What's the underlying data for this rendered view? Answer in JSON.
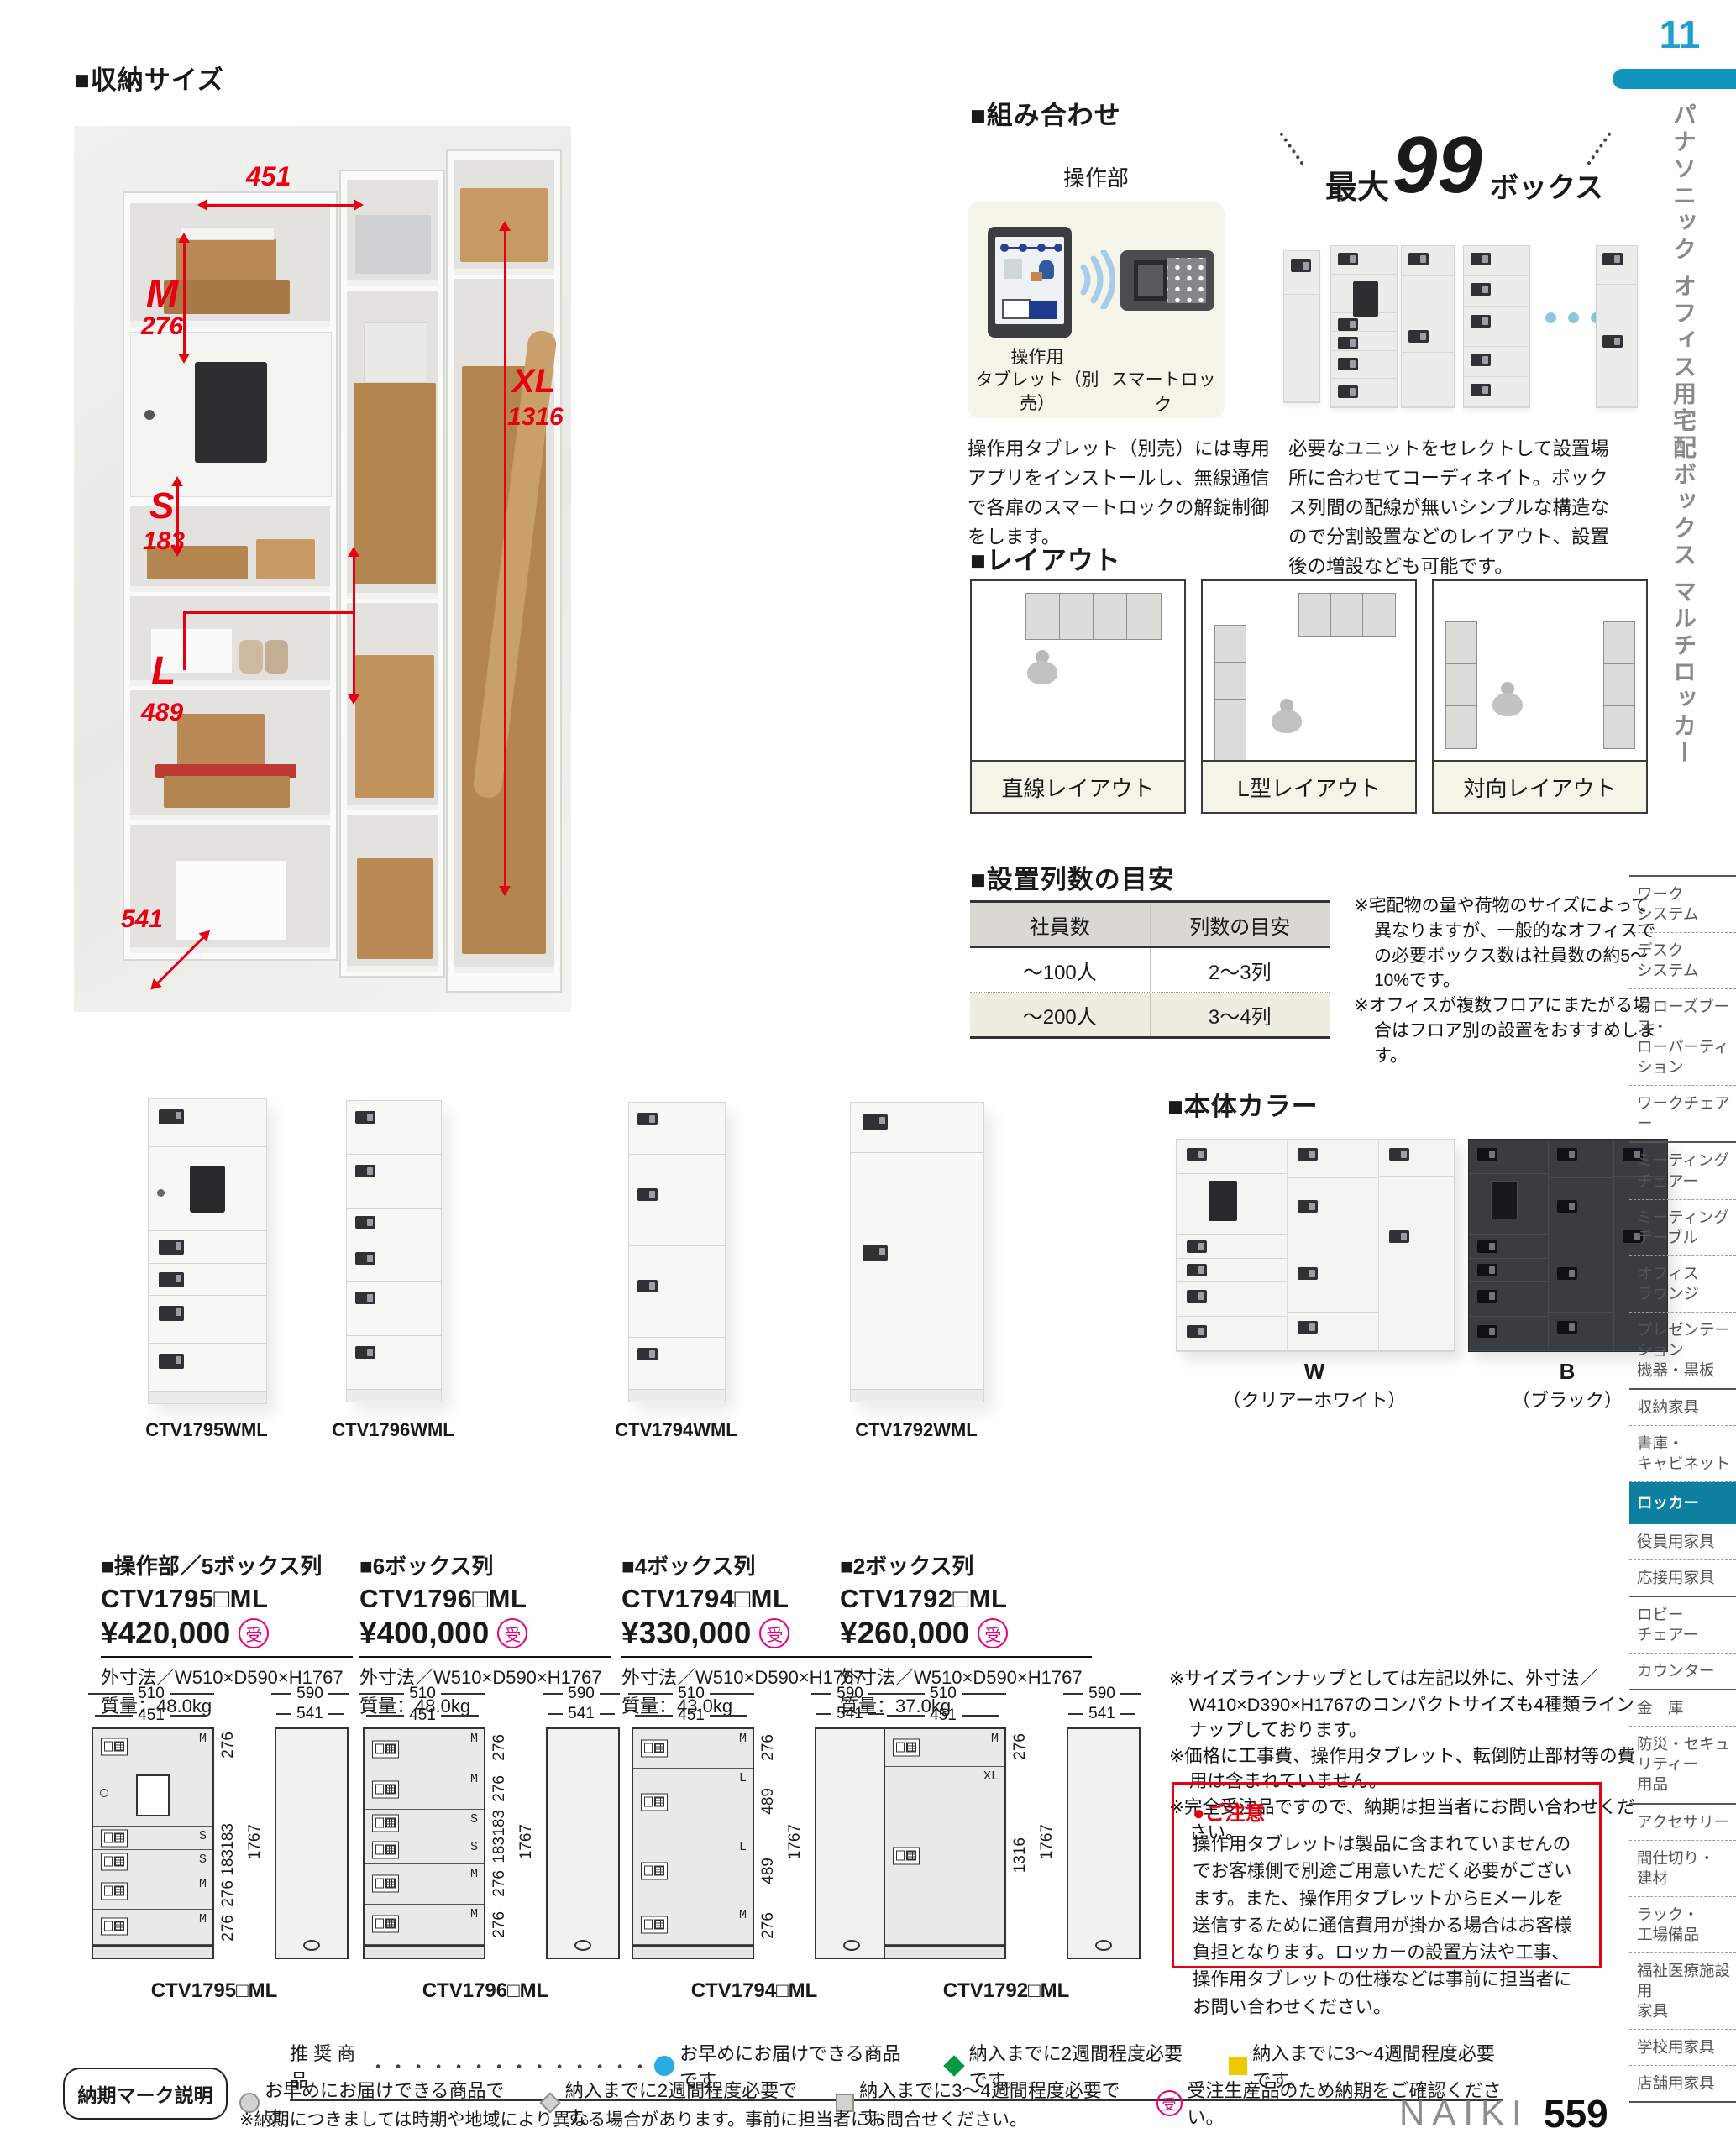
{
  "page": {
    "number": "11",
    "catalog_code": "559",
    "brand": "NAIKI",
    "side_title": "パナソニック オフィス用宅配ボックス マルチロッカー"
  },
  "colors": {
    "accent_red": "#e60012",
    "brand_blue": "#1f9fd0",
    "bar_blue": "#1095c1",
    "sidebar_highlight": "#0e7f9e",
    "order_pink": "#e4007f",
    "beige": "#f5f4e8",
    "mark_blue": "#29abe2",
    "mark_green": "#009944",
    "mark_yellow": "#efc800"
  },
  "storage_size": {
    "heading": "■収納サイズ",
    "dims": {
      "width": "451",
      "m_label": "M",
      "m": "276",
      "s_label": "S",
      "s": "183",
      "l_label": "L",
      "l": "489",
      "xl_label": "XL",
      "xl": "1316",
      "depth": "541"
    }
  },
  "combination": {
    "heading": "■組み合わせ",
    "control_label": "操作部",
    "tablet_label": "操作用\nタブレット（別売）",
    "smartlock_label": "スマートロック",
    "max_prefix": "最大",
    "max_number": "99",
    "max_suffix": "ボックス",
    "left_text": "操作用タブレット（別売）には専用アプリをインストールし、無線通信で各扉のスマートロックの解錠制御をします。",
    "right_text": "必要なユニットをセレクトして設置場所に合わせてコーディネイト。ボックス列間の配線が無いシンプルな構造なので分割設置などのレイアウト、設置後の増設なども可能です。"
  },
  "layout": {
    "heading": "■レイアウト",
    "items": [
      {
        "label": "直線レイアウト"
      },
      {
        "label": "L型レイアウト"
      },
      {
        "label": "対向レイアウト"
      }
    ]
  },
  "rows_guide": {
    "heading": "■設置列数の目安",
    "table": {
      "headers": [
        "社員数",
        "列数の目安"
      ],
      "rows": [
        [
          "～100人",
          "2～3列"
        ],
        [
          "～200人",
          "3～4列"
        ]
      ]
    },
    "notes": [
      "※宅配物の量や荷物のサイズによって異なりますが、一般的なオフィスでの必要ボックス数は社員数の約5～10%です。",
      "※オフィスが複数フロアにまたがる場合はフロア別の設置をおすすめします。"
    ]
  },
  "products": [
    {
      "photo_label": "CTV1795WML",
      "title": "■操作部／5ボックス列",
      "model": "CTV1795□ML",
      "price": "¥420,000",
      "order_mark": "受",
      "outer": "外寸法／W510×D590×H1767",
      "weight": "質量：48.0kg"
    },
    {
      "photo_label": "CTV1796WML",
      "title": "■6ボックス列",
      "model": "CTV1796□ML",
      "price": "¥400,000",
      "order_mark": "受",
      "outer": "外寸法／W510×D590×H1767",
      "weight": "質量：48.0kg"
    },
    {
      "photo_label": "CTV1794WML",
      "title": "■4ボックス列",
      "model": "CTV1794□ML",
      "price": "¥330,000",
      "order_mark": "受",
      "outer": "外寸法／W510×D590×H1767",
      "weight": "質量：43.0kg"
    },
    {
      "photo_label": "CTV1792WML",
      "title": "■2ボックス列",
      "model": "CTV1792□ML",
      "price": "¥260,000",
      "order_mark": "受",
      "outer": "外寸法／W510×D590×H1767",
      "weight": "質量：37.0kg"
    }
  ],
  "body_color": {
    "heading": "■本体カラー",
    "options": [
      {
        "code": "W",
        "name": "（クリアーホワイト）"
      },
      {
        "code": "B",
        "name": "（ブラック）"
      }
    ]
  },
  "size_notes": [
    "※サイズラインナップとしては左記以外に、外寸法／W410×D390×H1767のコンパクトサイズも4種類ラインナップしております。",
    "※価格に工事費、操作用タブレット、転倒防止部材等の費用は含まれていません。",
    "※完全受注品ですので、納期は担当者にお問い合わせください。"
  ],
  "caution": {
    "title": "●ご注意",
    "text": "操作用タブレットは製品に含まれていませんのでお客様側で別途ご用意いただく必要がございます。また、操作用タブレットからEメールを送信するために通信費用が掛かる場合はお客様負担となります。ロッカーの設置方法や工事、操作用タブレットの仕様などは事前に担当者にお問い合わせください。"
  },
  "drawings": {
    "front_w": "510",
    "front_inner": "451",
    "side_w": "590",
    "side_inner": "541",
    "total_h": "1767",
    "items": [
      {
        "model": "CTV1795□ML",
        "cells": [
          {
            "label": "M",
            "dim": "276"
          },
          {
            "label": "",
            "dim": ""
          },
          {
            "label": "S",
            "dim": "183"
          },
          {
            "label": "S",
            "dim": "183"
          },
          {
            "label": "M",
            "dim": "276"
          },
          {
            "label": "M",
            "dim": "276"
          }
        ]
      },
      {
        "model": "CTV1796□ML",
        "cells": [
          {
            "label": "M",
            "dim": "276"
          },
          {
            "label": "M",
            "dim": "276"
          },
          {
            "label": "S",
            "dim": "183"
          },
          {
            "label": "S",
            "dim": "183"
          },
          {
            "label": "M",
            "dim": "276"
          },
          {
            "label": "M",
            "dim": "276"
          }
        ]
      },
      {
        "model": "CTV1794□ML",
        "cells": [
          {
            "label": "M",
            "dim": "276"
          },
          {
            "label": "L",
            "dim": "489"
          },
          {
            "label": "L",
            "dim": "489"
          },
          {
            "label": "M",
            "dim": "276"
          }
        ]
      },
      {
        "model": "CTV1792□ML",
        "cells": [
          {
            "label": "M",
            "dim": "276"
          },
          {
            "label": "XL",
            "dim": "1316"
          }
        ]
      }
    ]
  },
  "footer": {
    "box_label": "納期マーク説明",
    "line1_label": "推 奨 商 品",
    "dots": "・・・・・・・・・・・・・・",
    "marks_row1": [
      {
        "icon": "circle-blue",
        "text": "お早めにお届けできる商品です。"
      },
      {
        "icon": "diamond-green",
        "text": "納入までに2週間程度必要です。"
      },
      {
        "icon": "square-yellow",
        "text": "納入までに3～4週間程度必要です。"
      }
    ],
    "marks_row2": [
      {
        "icon": "circle-gray",
        "text": "お早めにお届けできる商品です。"
      },
      {
        "icon": "diamond-gray",
        "text": "納入までに2週間程度必要です。"
      },
      {
        "icon": "square-gray",
        "text": "納入までに3～4週間程度必要です。"
      },
      {
        "icon": "order-mark",
        "glyph": "受",
        "text": "受注生産品のため納期をご確認ください。"
      }
    ],
    "note": "※納期につきましては時期や地域により異なる場合があります。事前に担当者にお問合せください。"
  },
  "sidebar": {
    "items": [
      {
        "label": "ワーク\nシステム"
      },
      {
        "label": "デスク\nシステム"
      },
      {
        "label": "クローズブース・\nローパーティション"
      },
      {
        "label": "ワークチェアー"
      },
      {
        "label": "ミーティング\nチェアー"
      },
      {
        "label": "ミーティング\nテーブル"
      },
      {
        "label": "オフィス\nラウンジ"
      },
      {
        "label": "プレゼンテーション\n機器・黒板"
      },
      {
        "label": "収納家具"
      },
      {
        "label": "書庫・\nキャビネット"
      },
      {
        "label": "ロッカー",
        "active": true
      },
      {
        "label": "役員用家具"
      },
      {
        "label": "応接用家具"
      },
      {
        "label": "ロビー\nチェアー"
      },
      {
        "label": "カウンター"
      },
      {
        "label": "金　庫"
      },
      {
        "label": "防災・セキュリティー\n用品"
      },
      {
        "label": "アクセサリー"
      },
      {
        "label": "間仕切り・\n建材"
      },
      {
        "label": "ラック・\n工場備品"
      },
      {
        "label": "福祉医療施設用\n家具"
      },
      {
        "label": "学校用家具"
      },
      {
        "label": "店舗用家具"
      }
    ]
  }
}
